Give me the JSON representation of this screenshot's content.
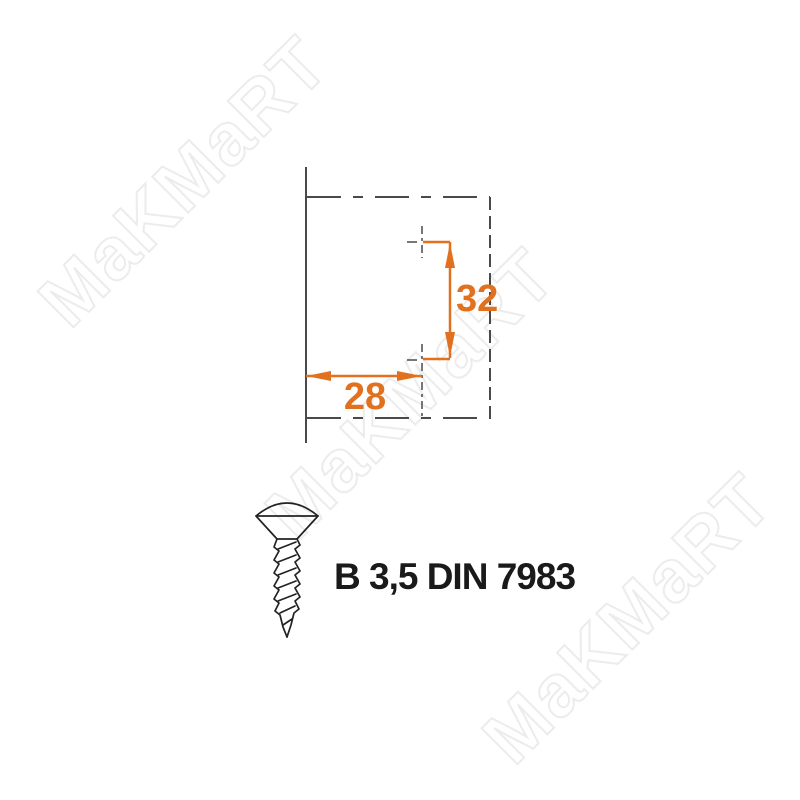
{
  "watermark": {
    "text": "MaKMaRT",
    "stroke_color": "#ececec"
  },
  "drawing": {
    "vertical_dim_label": "32",
    "horizontal_dim_label": "28",
    "accent_color": "#e2711f",
    "line_color": "#4a4a4a"
  },
  "screw": {
    "spec_label": "B 3,5 DIN 7983"
  }
}
